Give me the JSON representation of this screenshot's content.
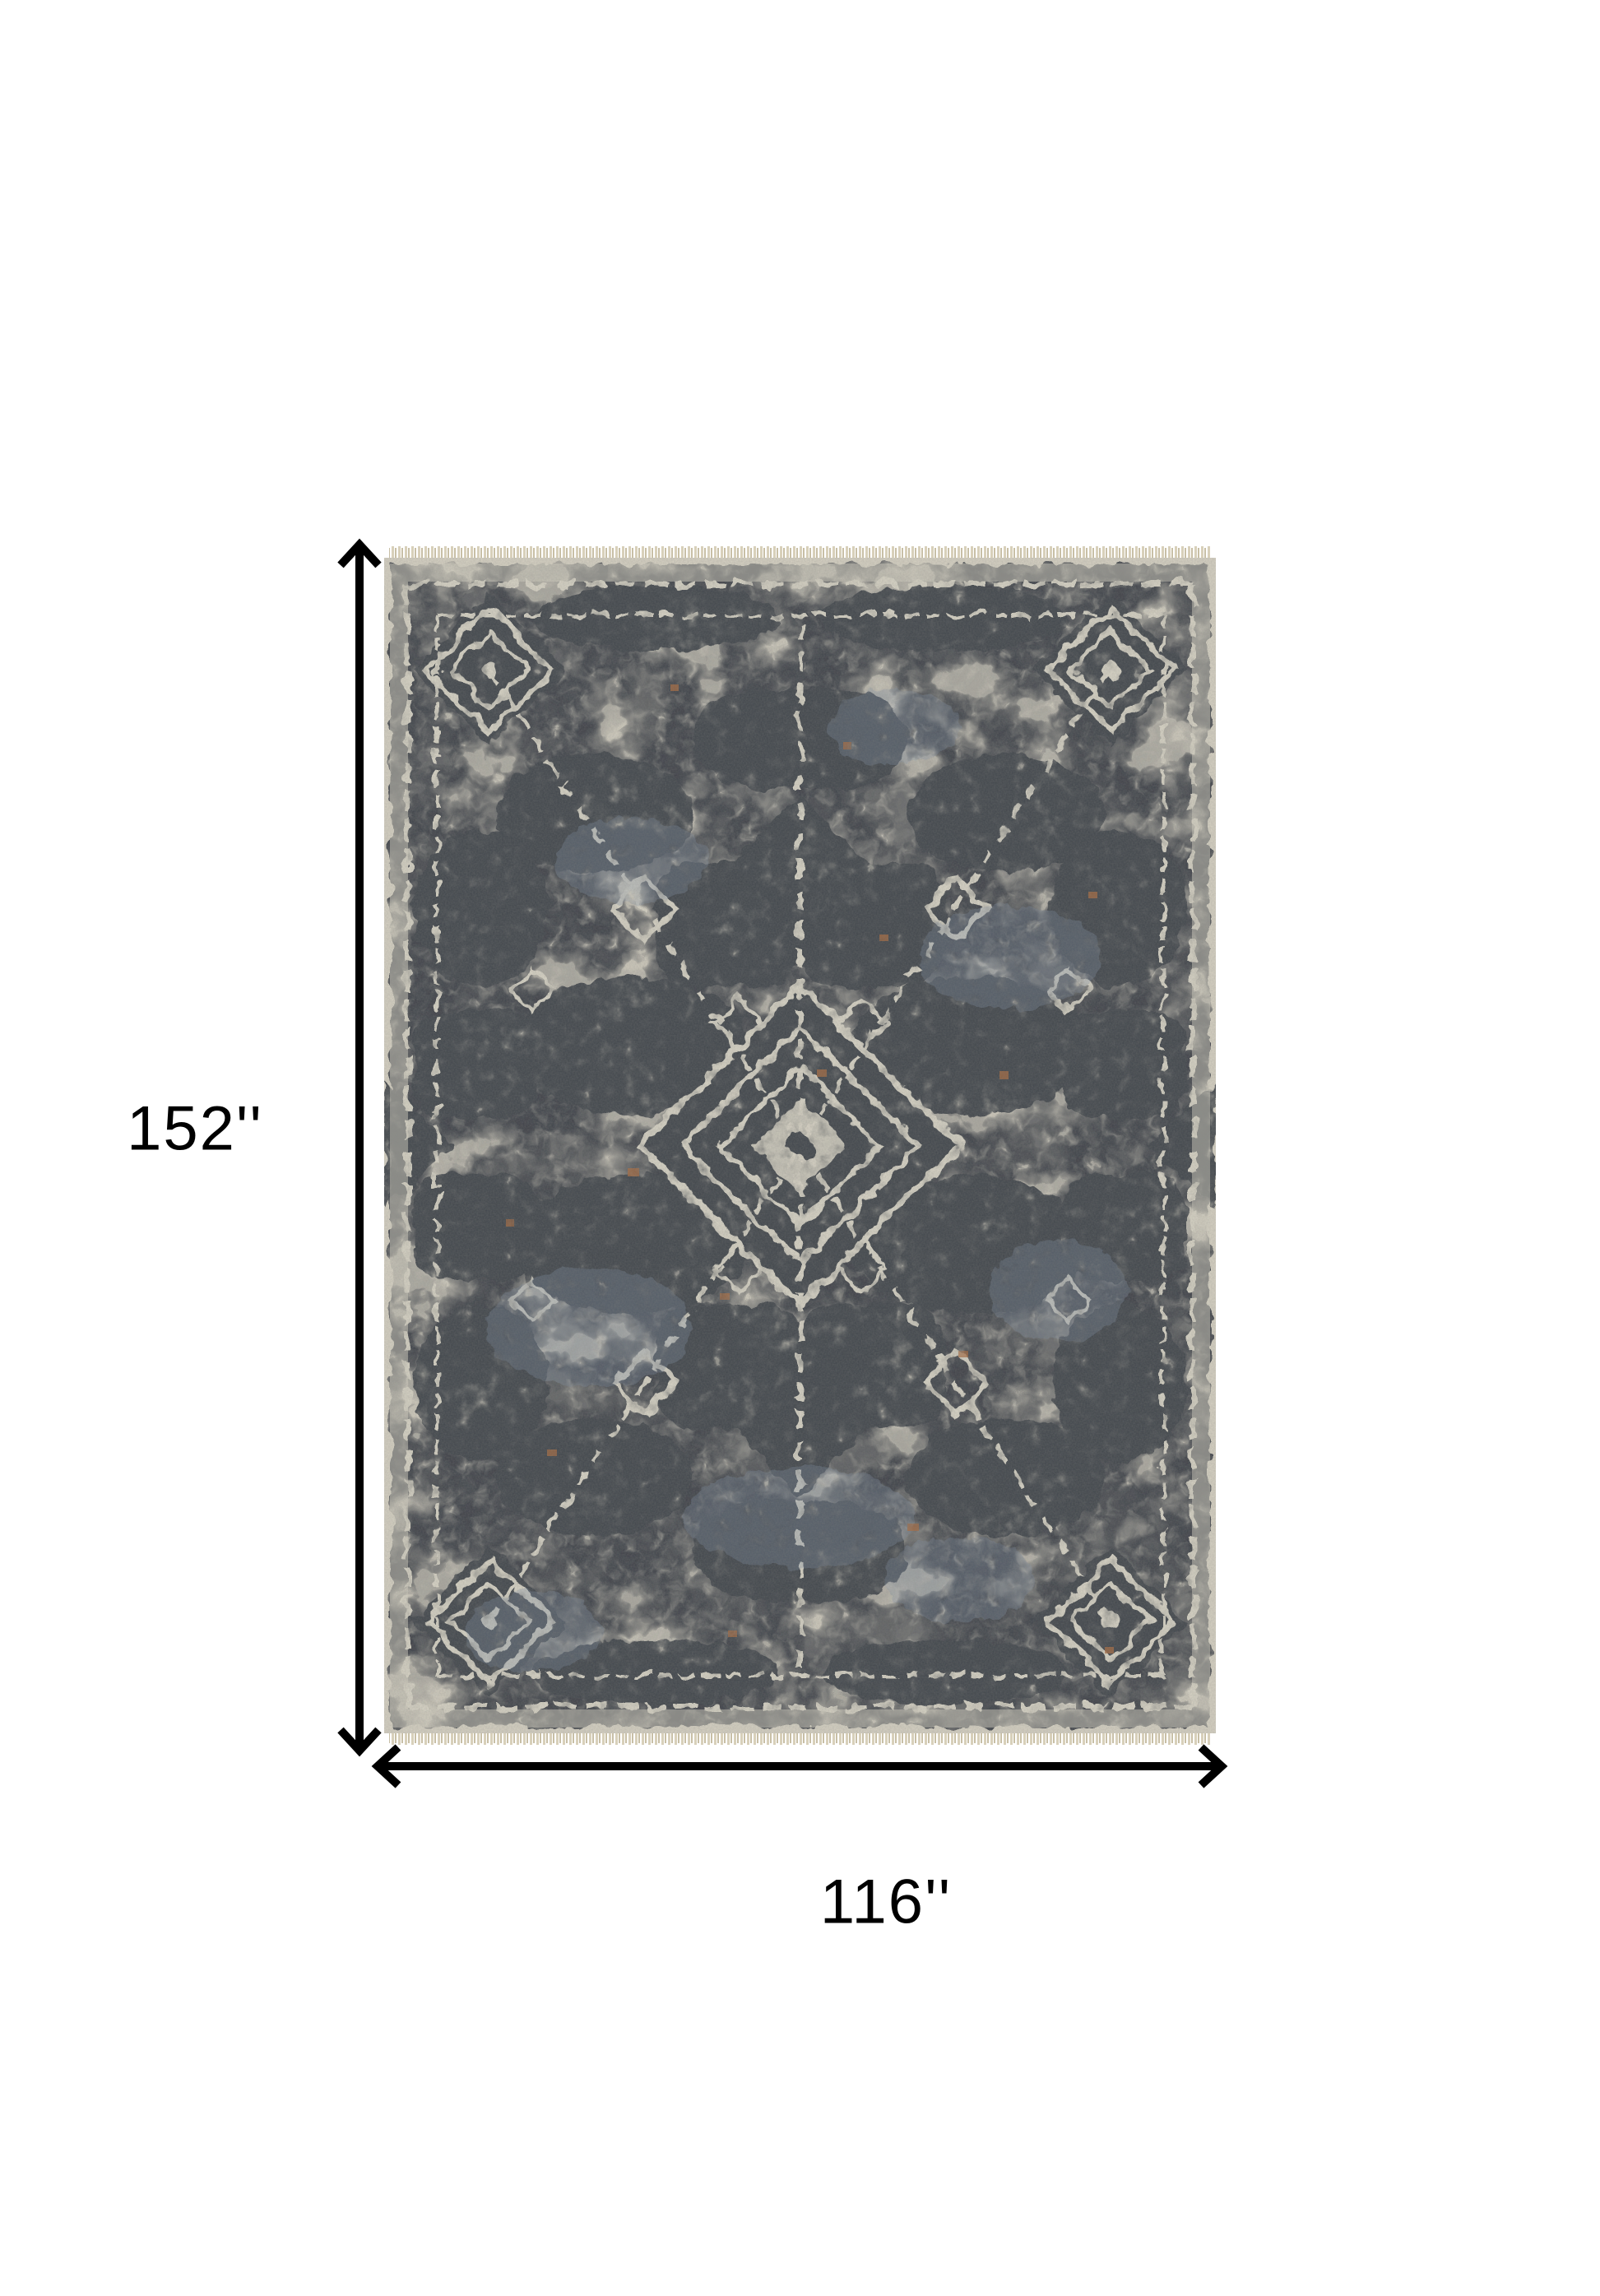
{
  "diagram": {
    "height_label": "152''",
    "width_label": "116''"
  },
  "rug": {
    "kind": "distressed-oriental-area-rug",
    "colors": {
      "ivory_base": "#d7d2c4",
      "charcoal_pattern": "#3f434a",
      "blue_gray_accent": "#8090a6",
      "rust_accent": "#a96b40",
      "fringe": "#d8d0ba"
    }
  },
  "annotation": {
    "arrow_color": "#000000",
    "label_color": "#000000",
    "background": "#ffffff"
  }
}
